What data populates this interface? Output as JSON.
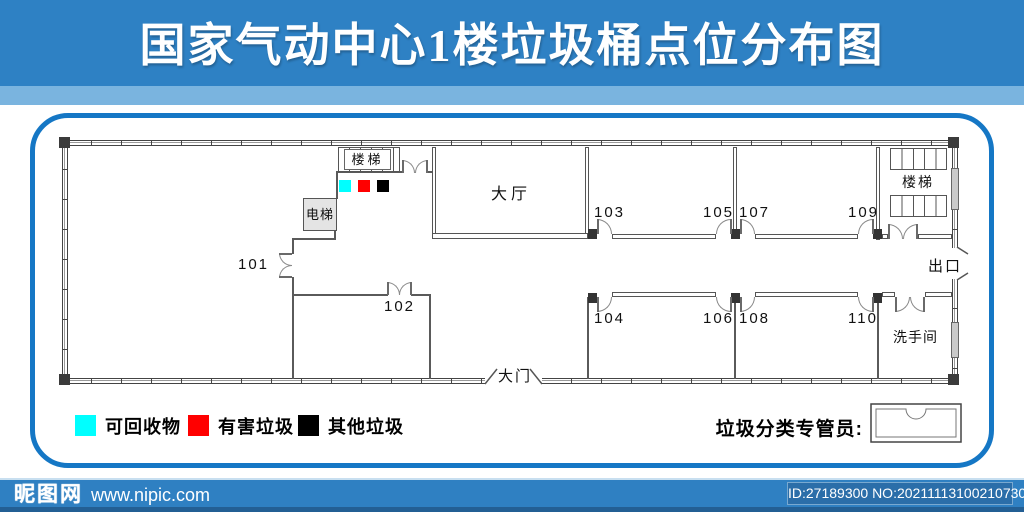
{
  "title": "国家气动中心1楼垃圾桶点位分布图",
  "plan": {
    "room_labels": [
      "101",
      "102",
      "103",
      "104",
      "105",
      "106",
      "107",
      "108",
      "109",
      "110"
    ],
    "hall_label": "大厅",
    "stairs_left_label": "楼梯",
    "stairs_right_label": "楼梯",
    "elevator_label": "电梯",
    "exit_label": "出口",
    "restroom_label": "洗手间",
    "gate_label": "大门",
    "bin_colors": {
      "recyclable": "#00ffff",
      "hazardous": "#ff0000",
      "other": "#000000"
    }
  },
  "legend": {
    "items": [
      {
        "label": "可回收物",
        "color": "#00ffff"
      },
      {
        "label": "有害垃圾",
        "color": "#ff0000"
      },
      {
        "label": "其他垃圾",
        "color": "#000000"
      }
    ]
  },
  "supervisor_label": "垃圾分类专管员:",
  "footer": {
    "site_name": "昵图网",
    "site_url": "www.nipic.com",
    "id_text": "ID:27189300 NO:20211113100210730103"
  },
  "colors": {
    "header_blue": "#2e81c4",
    "band_light_blue": "#7ab4df",
    "panel_border_blue": "#1577c5",
    "footer_blue": "#2f80c2"
  }
}
